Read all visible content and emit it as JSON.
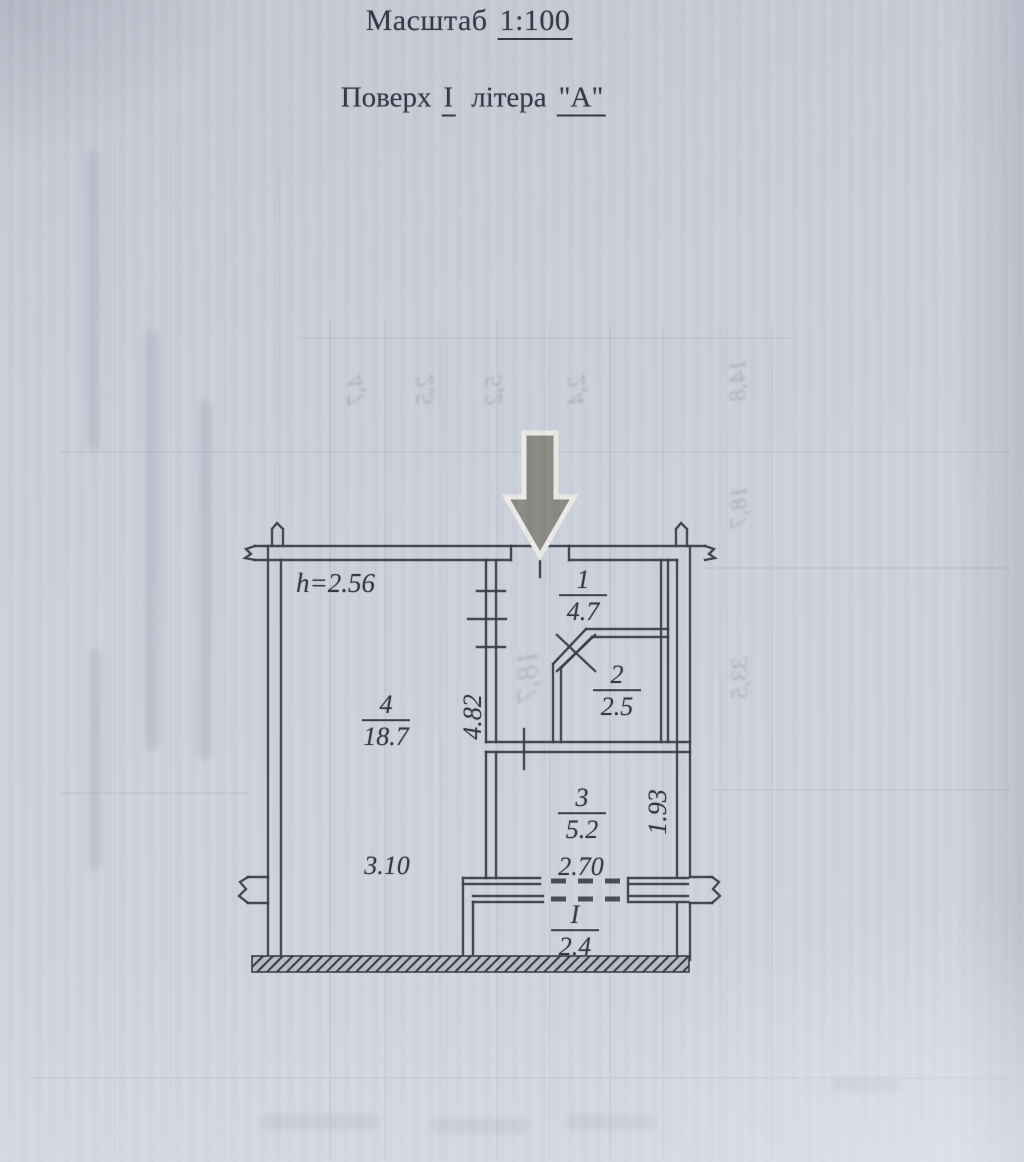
{
  "page": {
    "scale_label": "Масштаб",
    "scale_value": "1:100",
    "floor_word": "Поверх",
    "floor_value": "І",
    "letter_word": "літера",
    "letter_value": "\"А\""
  },
  "plan": {
    "ceiling_height": "h=2.56",
    "rooms": [
      {
        "num": "1",
        "area": "4.7"
      },
      {
        "num": "2",
        "area": "2.5"
      },
      {
        "num": "3",
        "area": "5.2"
      },
      {
        "num": "4",
        "area": "18.7"
      },
      {
        "num": "I",
        "area": "2.4"
      }
    ],
    "dims": {
      "room4_height": "4.82",
      "room4_width": "3.10",
      "room3_width": "2.70",
      "balcony_depth": "1.93"
    }
  },
  "bleedthrough": {
    "items": [
      {
        "text": "4,7"
      },
      {
        "text": "2,5"
      },
      {
        "text": "5,2"
      },
      {
        "text": "2,4"
      },
      {
        "text": "14,8"
      },
      {
        "text": "18,7"
      },
      {
        "text": "33,5"
      },
      {
        "text": "18,7"
      }
    ]
  },
  "colors": {
    "paper": "#cdd2dc",
    "ink": "#3a3e49",
    "arrow_fill": "#8b8b85",
    "arrow_outline": "#eceae6",
    "bleed_text": "#8d94a4"
  }
}
